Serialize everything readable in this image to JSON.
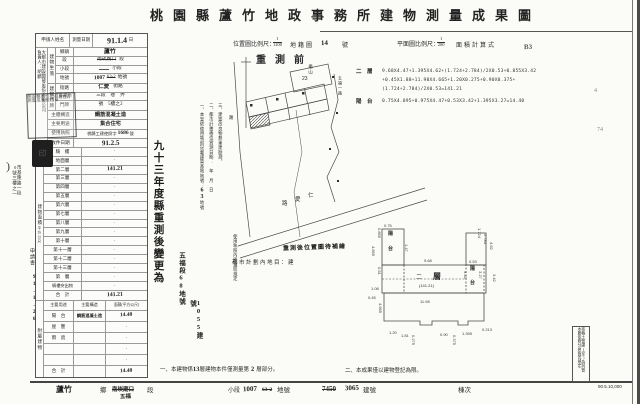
{
  "title": "桃園縣蘆竹地政事務所建物測量成果圖",
  "scales": {
    "loc_label": "位置圖比例尺：",
    "loc_num": "1",
    "loc_den": "1200",
    "cad": "地籍圖",
    "cad_no": "14",
    "cad_suf": "號",
    "plan_label": "平面圖比例尺：",
    "plan_num": "1",
    "plan_den": "200",
    "area_label": "面積計算式",
    "pencil_b3": "B3",
    "pencil_4": "4",
    "pencil_74": "74"
  },
  "form": {
    "applicant_label": "申請人姓名",
    "company": "大都市建設開發股份有限公司",
    "owner": "負責人：胡麟",
    "survey_label": "測量日期",
    "survey_value": "91.1.4",
    "survey_suffix": "日",
    "loc_group": "建物坐落",
    "loc_rows": {
      "r1_label": "鄉鎮",
      "r1_value": "蘆竹",
      "r2_label": "段",
      "r2_struck": "南崁廟口",
      "r2_suffix": "段",
      "r3_label": "小段",
      "r3_suffix": "小段",
      "r4_label": "地號",
      "r4_hand": "1007",
      "r4_struck": "63-2",
      "r4_suffix": "地號"
    },
    "door_group": "建物門牌",
    "door_rows": {
      "r1_label": "街路",
      "r1_value": "仁愛",
      "r1_suffix": "街路",
      "r2_label": "段巷弄",
      "r2_value": "三段　巷　弄",
      "r3_label": "門牌",
      "r3_value": "號　5樓之2"
    },
    "structure_label": "主體構造",
    "structure_value": "鋼筋混凝土造",
    "use_label": "主要用途",
    "use_value": "集合住宅",
    "license_label": "使用執照",
    "license_pre": "桃縣工建使照字",
    "license_no": "1686",
    "license_suf": "號",
    "receipt_label": "收件日期",
    "receipt_value": "91.2.5",
    "floors_group": "建物面積",
    "floors_unit": "平方公尺",
    "floors": [
      {
        "n": "騎　樓",
        "v": "·"
      },
      {
        "n": "地面層",
        "v": "·"
      },
      {
        "n": "第二層",
        "v": "141.21"
      },
      {
        "n": "第三層",
        "v": "·"
      },
      {
        "n": "第四層",
        "v": "·"
      },
      {
        "n": "第五層",
        "v": "·"
      },
      {
        "n": "第六層",
        "v": "·"
      },
      {
        "n": "第七層",
        "v": "·"
      },
      {
        "n": "第八層",
        "v": "·"
      },
      {
        "n": "第九層",
        "v": "·"
      },
      {
        "n": "第十層",
        "v": "·"
      },
      {
        "n": "第十一層",
        "v": "·"
      },
      {
        "n": "第十二層",
        "v": "·"
      },
      {
        "n": "第十三層",
        "v": "·"
      },
      {
        "n": "第　層",
        "v": "·"
      },
      {
        "n": "騎樓突出物",
        "v": "·"
      },
      {
        "n": "合　計",
        "v": "141.21"
      }
    ],
    "annex_group": "附屬建物",
    "annex_headers": [
      "主要用途",
      "主要構造",
      "面積(平方公尺)"
    ],
    "annex": [
      {
        "u": "陽　台",
        "c": "鋼筋混凝土造",
        "a": "14.40"
      },
      {
        "u": "屋　簷",
        "c": "",
        "a": "·"
      },
      {
        "u": "雨　遮",
        "c": "",
        "a": "·"
      },
      {
        "u": "",
        "c": "",
        "a": "·"
      },
      {
        "u": "",
        "c": "",
        "a": "·"
      },
      {
        "u": "合　計",
        "c": "",
        "a": "14.40"
      }
    ]
  },
  "left_margin": {
    "paren": ")",
    "address1": "市基隆路一段",
    "address2": "0號三樓之一",
    "form_name": "申請書",
    "date": "91.1.26",
    "seal_text": "桃園縣蘆竹地政事務所測量成果校核章",
    "seal_small": "印"
  },
  "notes_vertical": {
    "hand_big": "九十三年度縣重測後變更為",
    "hand_seg": "五福段68地號",
    "hand_bld": "1055建號",
    "n1a": "一、本案依使用執照記載建築基地地號：",
    "n1b": "63",
    "n1c": "地號",
    "n2": "二、都市計畫樁位實測日期：　年　月　日",
    "n3": "三、建築改良物無重建勘測。",
    "n4": "使用執照內應遵照規定"
  },
  "map": {
    "title": "重測前",
    "lot_name": "龜山",
    "lot_no": "23",
    "road_b1": "路",
    "road_b2": "愛",
    "road_b3": "仁",
    "road_right": "五福一路",
    "road_left": "路"
  },
  "annotations": {
    "resurvey": "重測後位置圖待補繪",
    "zoning": "都市計劃內地目：建"
  },
  "formula": {
    "floor_label": "二　層",
    "l1": "9.68X4.47+1.395X4.62+(1.724+2.784)/2X0.53+0.855X3.42",
    "l2": "+0.45X1.88+11.98X4.665+1.20X0.275+0.90X0.375+",
    "l3": "(1.724+2.784)/2X0.53=141.21",
    "balcony_label": "陽　台",
    "l4": "0.75X4.895+0.975X4.47+0.53X3.42+1.395X3.27=14.40"
  },
  "plan": {
    "floor_char1": "二",
    "floor_char2": "層",
    "area_note": "(141.21)",
    "balcony_a1": "陽",
    "balcony_a2": "台",
    "balcony_b1": "陽",
    "balcony_b2": "台",
    "dims": [
      {
        "v": "0.75"
      },
      {
        "v": "0.855"
      },
      {
        "v": "4.895"
      },
      {
        "v": "1.47"
      },
      {
        "v": "9.68"
      },
      {
        "v": "4.62"
      },
      {
        "v": "1.724"
      },
      {
        "v": "2.784"
      },
      {
        "v": "0.53"
      },
      {
        "v": "3.42"
      },
      {
        "v": "3.27"
      },
      {
        "v": "3.42"
      },
      {
        "v": "0.51"
      },
      {
        "v": "1.08"
      },
      {
        "v": "0.45"
      },
      {
        "v": "4.665"
      },
      {
        "v": "11.98"
      },
      {
        "v": "1.20"
      },
      {
        "v": "1.81"
      },
      {
        "v": "0.275"
      },
      {
        "v": "0.90"
      },
      {
        "v": "0.375"
      },
      {
        "v": "0.213"
      },
      {
        "v": "1.395"
      }
    ]
  },
  "footer": {
    "n1a": "一、本建物係",
    "n1b": "13",
    "n1c": "層建物本件僅測量第",
    "n1d": "2",
    "n1e": "層部分。",
    "n2": "二、本成果僅以建物登記為限。"
  },
  "bottom_row": {
    "twp_hand": "蘆竹",
    "twp": "鄉",
    "seg_struck": "南崁廟口",
    "seg_hand": "五福",
    "seg": "段",
    "subseg": "小段",
    "lot_hand": "1007",
    "lot_struck": "63-2",
    "lot": "地號",
    "bld_struck": "7450",
    "bld_hand": "3065",
    "bld": "建號",
    "unit": "棟次"
  },
  "print": {
    "batch": "90.5.10,000",
    "margin1": "核稿土管課(室)為列管",
    "margin2": "本聯依照分層負責規定"
  }
}
